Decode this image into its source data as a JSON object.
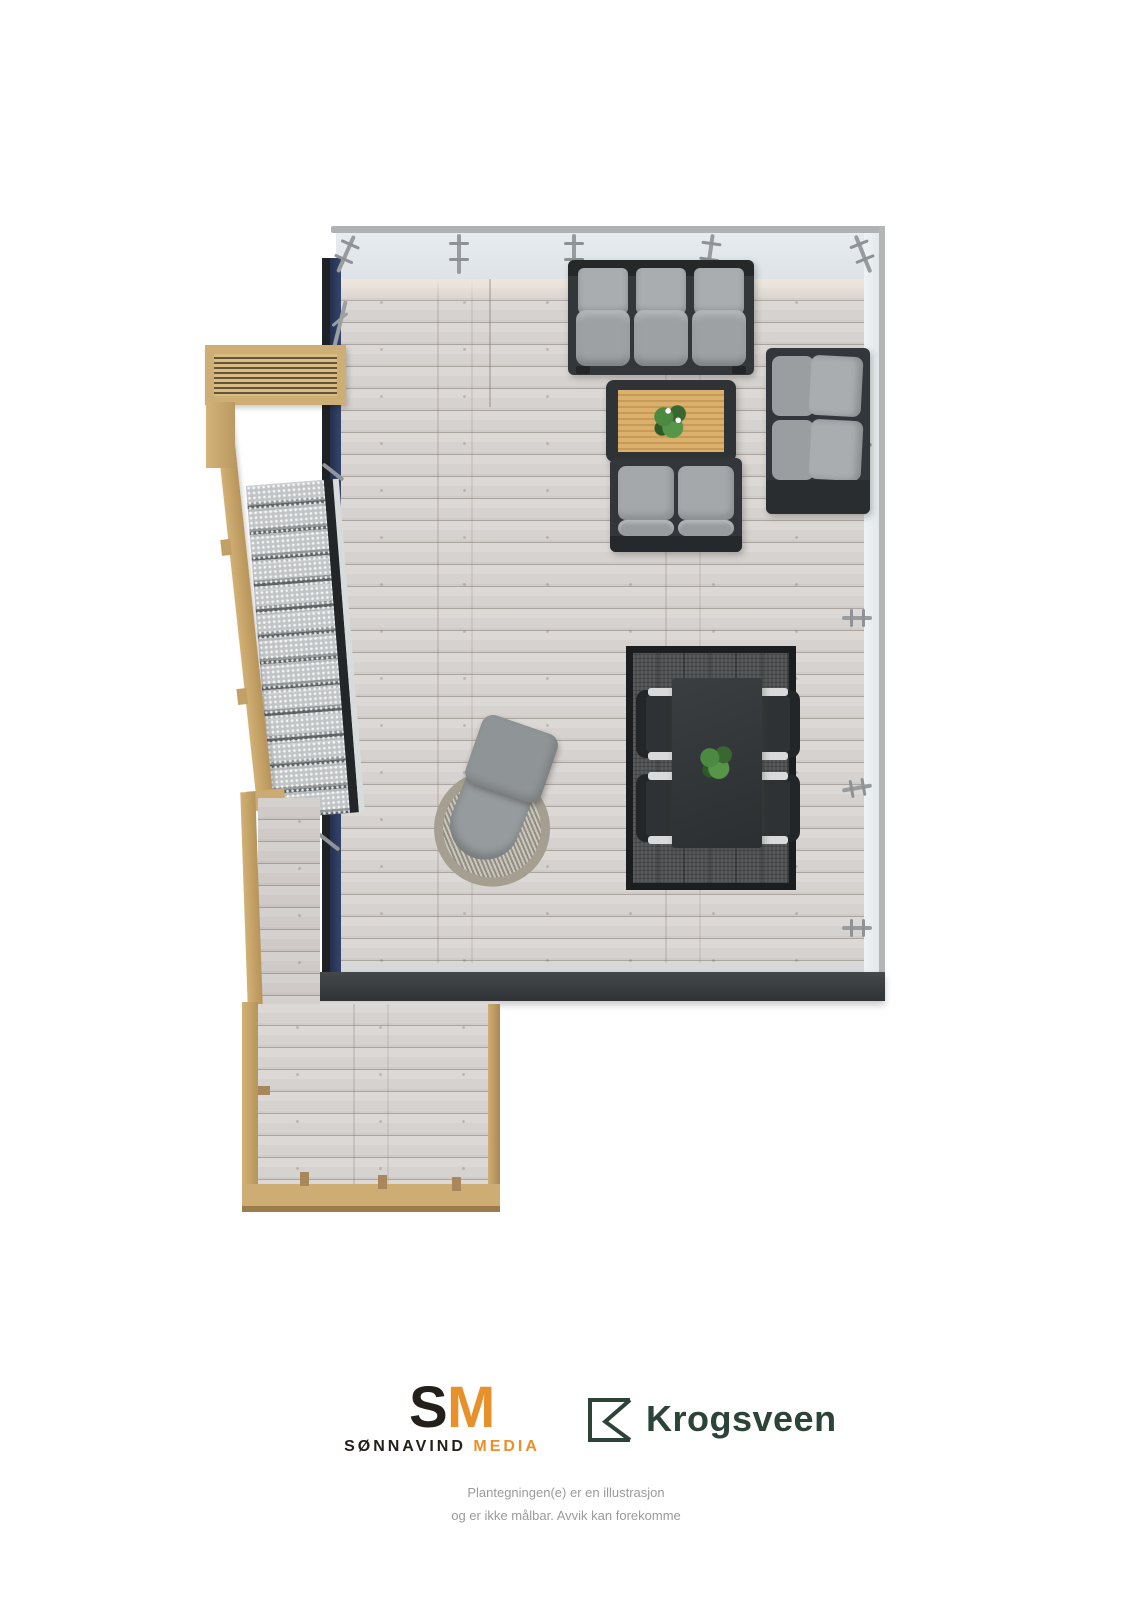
{
  "document": {
    "type": "3d-floorplan-illustration",
    "subject": "Roof terrace top-down 3D plan with outdoor furniture"
  },
  "branding": {
    "sonnavind_media": {
      "monogram_s": "S",
      "monogram_m": "M",
      "name_primary": "SØNNAVIND",
      "name_secondary": "MEDIA",
      "color_primary": "#23201b",
      "color_accent": "#e8912a"
    },
    "krogsveen": {
      "wordmark": "Krogsveen",
      "color": "#2c4438"
    }
  },
  "disclaimer": {
    "line1": "Plantegningen(e) er en illustrasjon",
    "line2": "og er ikke målbar. Avvik kan forekomme",
    "color": "#9b9b9b"
  },
  "scene": {
    "areas": [
      {
        "name": "main-terrace-deck"
      },
      {
        "name": "glass-railing-top-and-right"
      },
      {
        "name": "navy-facade-wall-left"
      },
      {
        "name": "external-metal-stairs"
      },
      {
        "name": "wood-slat-bench-pergola"
      },
      {
        "name": "lower-walkway-deck"
      },
      {
        "name": "dark-fascia-edge"
      }
    ],
    "furniture": [
      {
        "name": "three-seat-sofa"
      },
      {
        "name": "coffee-table-with-flower-plant"
      },
      {
        "name": "two-seat-sofa"
      },
      {
        "name": "two-seat-corner-sofa"
      },
      {
        "name": "dining-table-with-plant"
      },
      {
        "name": "dining-chair",
        "count": 4
      },
      {
        "name": "outdoor-rug"
      },
      {
        "name": "wicker-lounge-chair"
      }
    ],
    "colors": {
      "deck": "#d6d2cf",
      "glass": "#e8edf0",
      "railing_frame": "#b2b6b8",
      "navy_wall": "#2c3a5e",
      "fascia": "#3b3e40",
      "wood_trim": "#cdae75",
      "sofa_frame": "#34373a",
      "cushions": "#a3a7a9",
      "rug": "#4b4e50",
      "rug_border": "#1b1d1e",
      "dining_table": "#323537",
      "plants": "#4d8a41",
      "stairs_tread": "#c3c6c8",
      "table_top_wood": "#d3a863"
    }
  }
}
